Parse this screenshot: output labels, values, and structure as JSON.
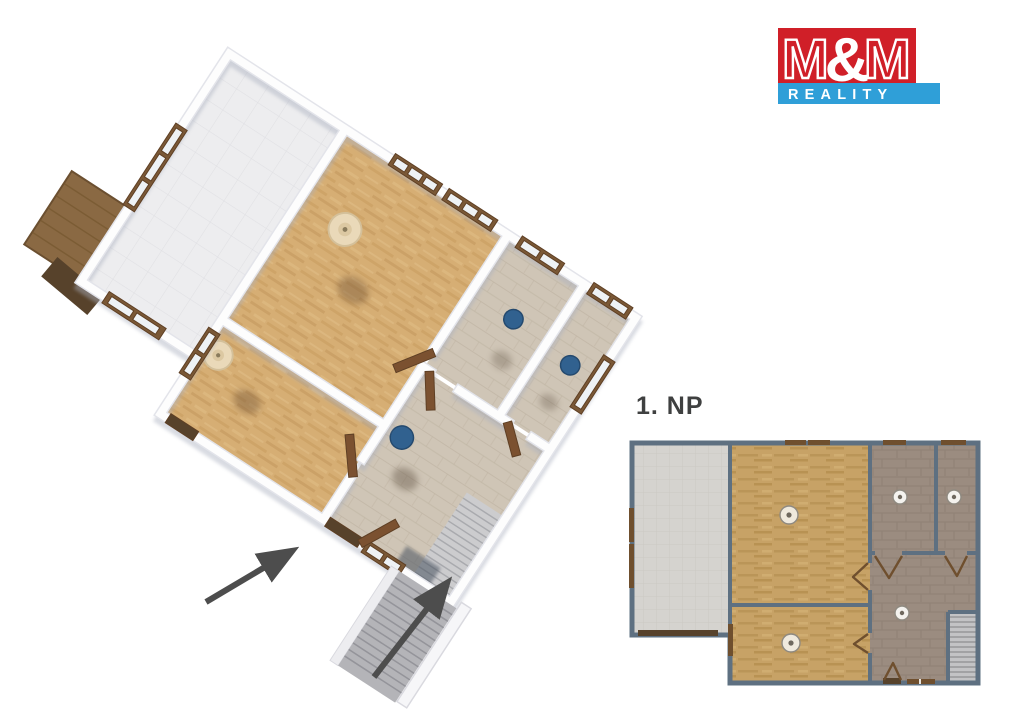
{
  "logo": {
    "m_left": "M",
    "ampersand": "&",
    "m_right": "M",
    "reality": "REALITY",
    "red": "#d01f28",
    "blue": "#2f9fd8",
    "text_color": "#ffffff"
  },
  "floor_label": {
    "text": "1. NP",
    "color": "#3f4040"
  },
  "colors": {
    "wall_2d": "#5e7081",
    "wood_floor_2d": "#c7a266",
    "taupe_floor_2d": "#9b8c80",
    "terrace_floor_2d": "#d5d3cf",
    "wood_floor_3d": "#d6ae74",
    "tile_floor_3d": "#cfc5b6",
    "terrace_floor_3d": "#ededef",
    "window_frame": "#7a5836",
    "door_brown": "#6f4f2e",
    "door_dark": "#57422b",
    "stairs_gray": "#c9c9cb",
    "arrow_gray": "#4d4d4d",
    "fixture_blue": "#31618f",
    "wall_3d_white": "#fdfdfd",
    "lamp_beige": "#ead9b9"
  }
}
